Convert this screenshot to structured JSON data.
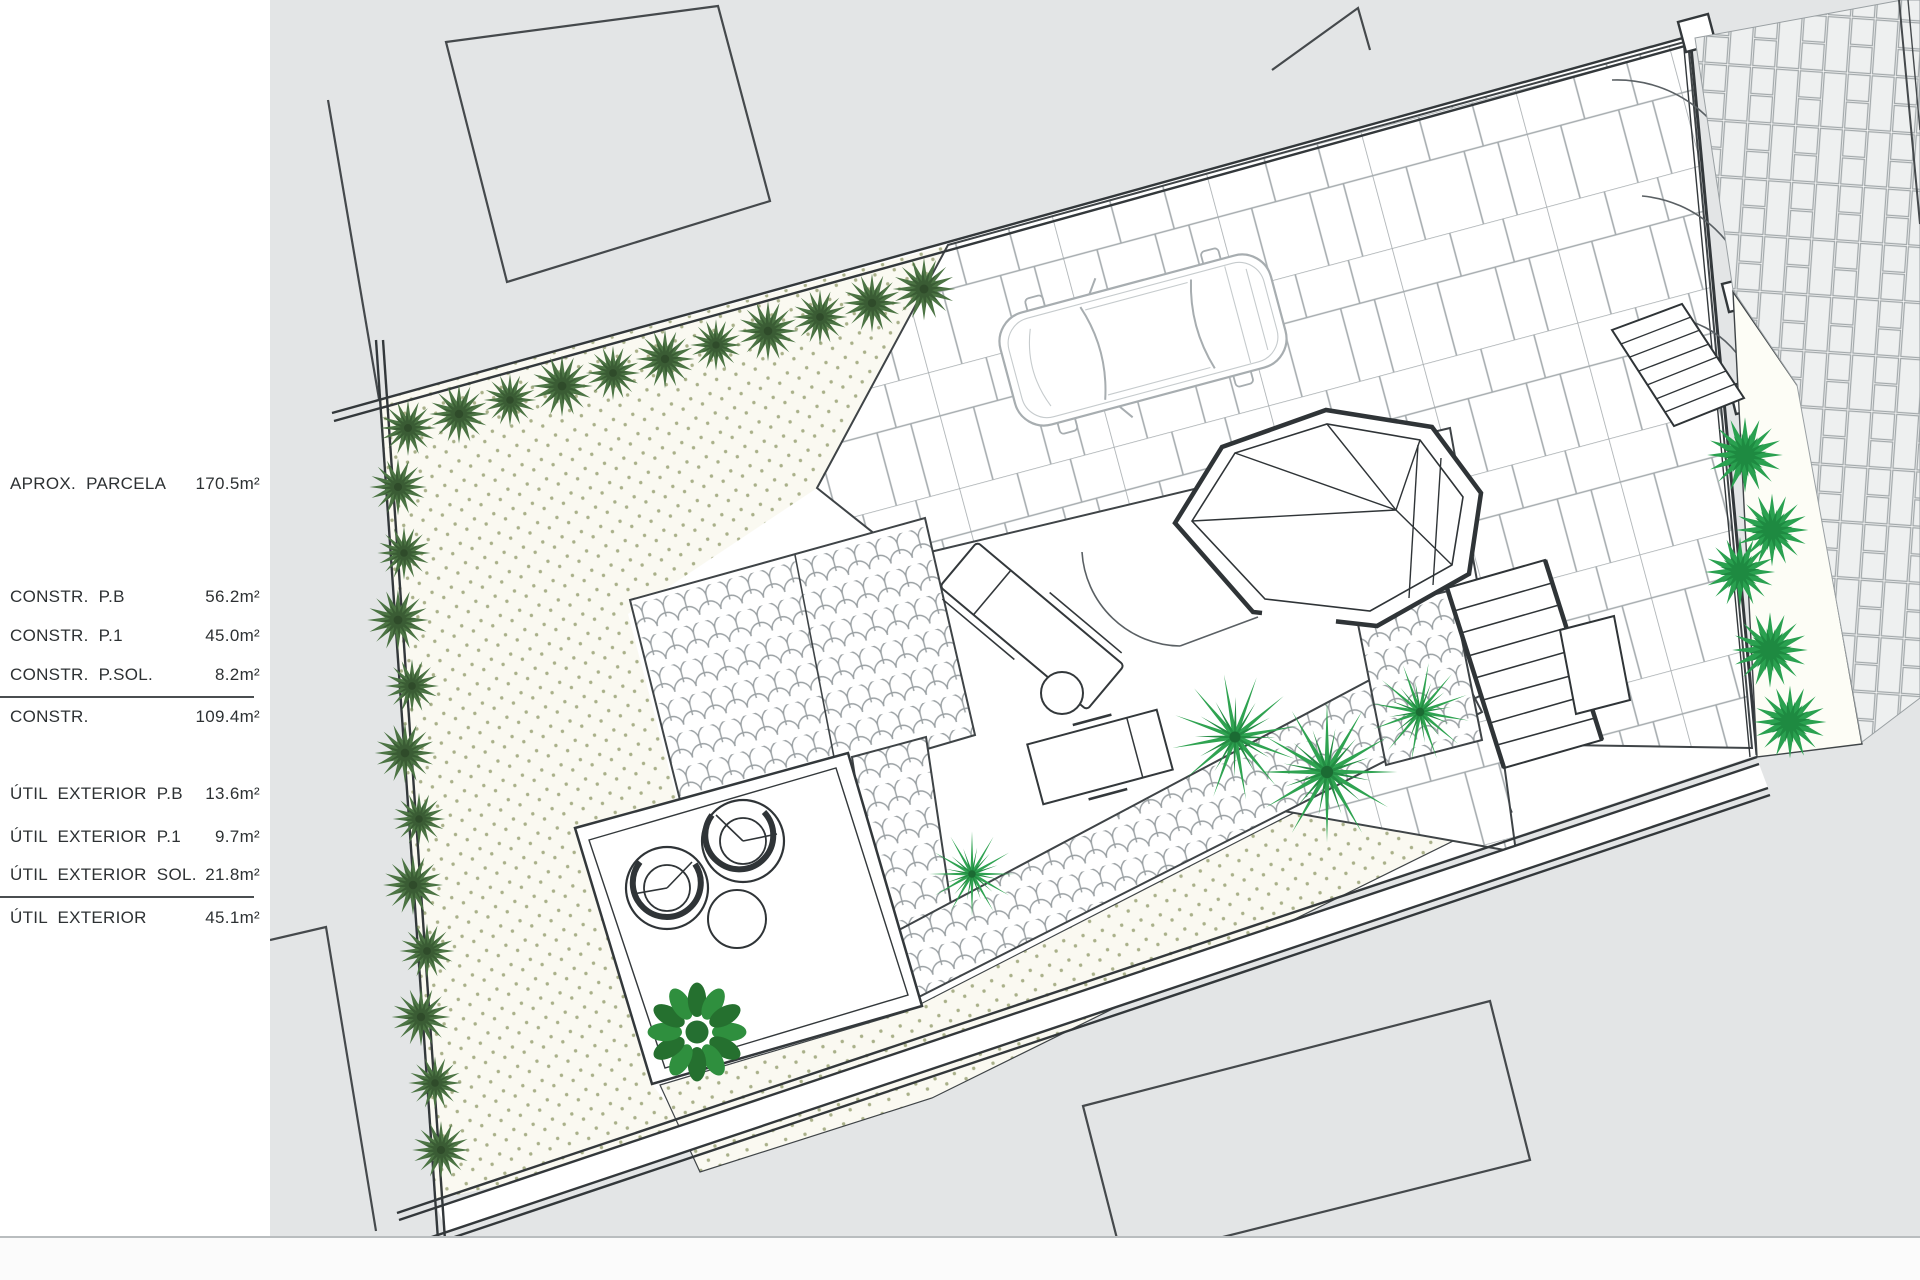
{
  "title": "Site plan drawing with area schedule",
  "legend": {
    "rows": [
      {
        "label": "APROX.  PARCELA",
        "value": "170.5m²"
      },
      {
        "label": "CONSTR.  P.B",
        "value": "56.2m²"
      },
      {
        "label": "CONSTR.  P.1",
        "value": "45.0m²"
      },
      {
        "label": "CONSTR.  P.SOL.",
        "value": "8.2m²"
      },
      {
        "label": "CONSTR.",
        "value": "109.4m²"
      },
      {
        "label": "ÚTIL  EXTERIOR  P.B",
        "value": "13.6m²"
      },
      {
        "label": "ÚTIL  EXTERIOR  P.1",
        "value": "9.7m²"
      },
      {
        "label": "ÚTIL  EXTERIOR  SOL.",
        "value": "21.8m²"
      },
      {
        "label": "ÚTIL  EXTERIOR",
        "value": "45.1m²"
      }
    ]
  },
  "palette": {
    "neighbor_gray": "#e3e5e6",
    "garden_cream": "#faf9f1",
    "stipple_dot": "#a9b089",
    "shrub_dark_green": "#4c7444",
    "plant_bright_green": "#2aa150",
    "line_dark": "#33383b",
    "paving_line_gray": "#a5abae"
  },
  "plan_features": [
    "parcel-boundary",
    "flagstone-driveway",
    "parked-car",
    "stair-tower",
    "cobblestone-patio-paths",
    "gravel-garden",
    "hedge-shrubs",
    "palm-plants",
    "lounge-furniture",
    "wicker-chairs",
    "entry-gates",
    "brick-sidewalk"
  ]
}
